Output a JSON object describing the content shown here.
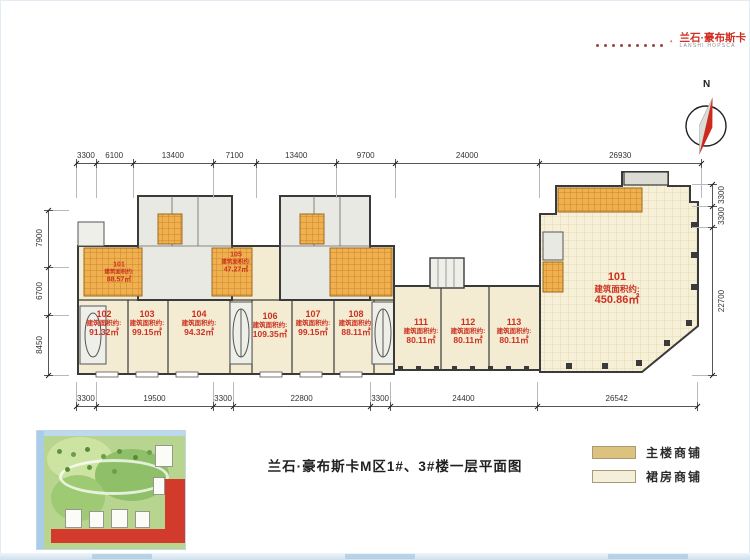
{
  "brand": {
    "dots": 9,
    "name_cn": "兰石·豪布斯卡",
    "name_en": "LANSHI HOPSCA"
  },
  "compass": {
    "label": "N"
  },
  "plan": {
    "area_prefix": "建筑面积约:",
    "units": [
      {
        "id": "101",
        "area": "88.57㎡",
        "x": 119,
        "y": 273,
        "size": "small"
      },
      {
        "id": "102",
        "area": "91.32㎡",
        "x": 104,
        "y": 323
      },
      {
        "id": "103",
        "area": "99.15㎡",
        "x": 147,
        "y": 323
      },
      {
        "id": "104",
        "area": "94.32㎡",
        "x": 199,
        "y": 323
      },
      {
        "id": "105",
        "area": "47.27㎡",
        "x": 236,
        "y": 263,
        "size": "small"
      },
      {
        "id": "106",
        "area": "109.35㎡",
        "x": 270,
        "y": 325
      },
      {
        "id": "107",
        "area": "99.15㎡",
        "x": 313,
        "y": 323
      },
      {
        "id": "108",
        "area": "88.11㎡",
        "x": 356,
        "y": 323
      },
      {
        "id": "111",
        "area": "80.11㎡",
        "x": 421,
        "y": 331
      },
      {
        "id": "112",
        "area": "80.11㎡",
        "x": 468,
        "y": 331
      },
      {
        "id": "113",
        "area": "80.11㎡",
        "x": 514,
        "y": 331
      },
      {
        "id": "101",
        "area": "450.86㎡",
        "x": 617,
        "y": 289,
        "size": "large"
      }
    ],
    "dims_top": [
      3300,
      6100,
      13400,
      7100,
      13400,
      9700,
      24000,
      26930
    ],
    "dims_bottom": [
      3300,
      19500,
      3300,
      22800,
      3300,
      24400,
      26542
    ],
    "dims_left": [
      7900,
      6700,
      8450
    ],
    "dims_right": [
      3300,
      3300,
      22700
    ]
  },
  "footer": {
    "title": "兰石·豪布斯卡M区1#、3#楼一层平面图",
    "legend": [
      {
        "label": "主楼商铺",
        "color": "#ddc17e"
      },
      {
        "label": "裙房商铺",
        "color": "#f4efdb"
      }
    ]
  },
  "colors": {
    "brand_red": "#cf2e21",
    "unit_label_red": "#cc3120",
    "wall": "#3a3a3a",
    "cream_fill": "#f3ecd2",
    "tile_orange": "#f0b050"
  }
}
